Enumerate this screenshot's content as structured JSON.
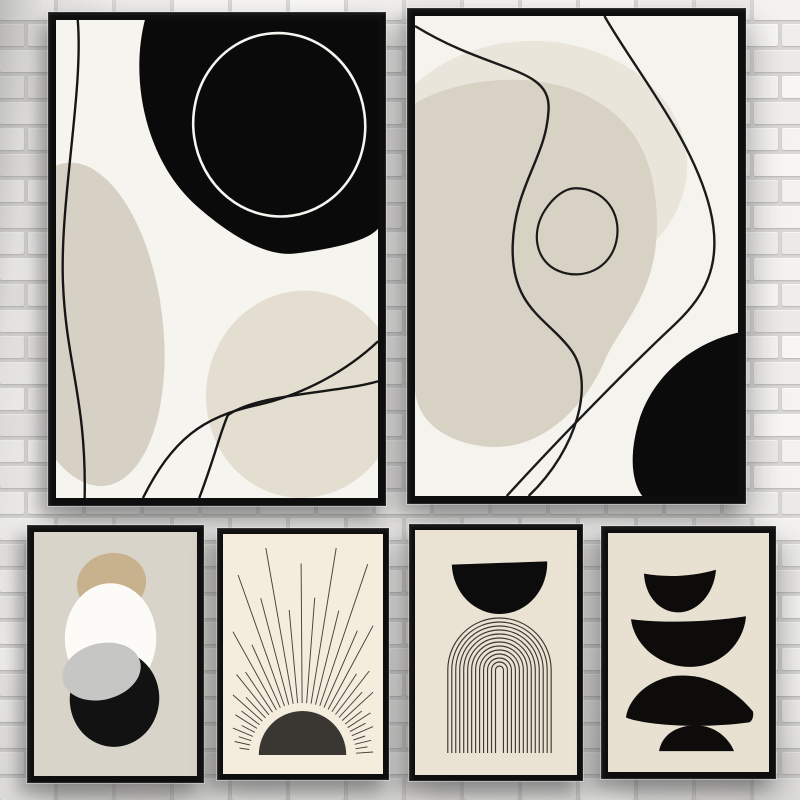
{
  "scene": {
    "description": "Photo of a gallery wall: six black-framed abstract boho art prints in black, off-white and beige hanging on a white painted brick wall",
    "wall": {
      "mortar_color": "#d9d8d6",
      "brick_colors": [
        "#f7f6f4",
        "#f3f2f0",
        "#efeeec",
        "#f4f3f1",
        "#eceae8"
      ]
    },
    "frame_color": "#0e0e0e"
  },
  "posters": [
    {
      "name": "abstract-black-blob-and-lines",
      "position": "top-left",
      "colors": {
        "bg": "#f6f4ef",
        "black": "#0a0a0a",
        "beige": "#d6d1c4",
        "beige_light": "#e3decf",
        "line": "#161616",
        "ring": "#f7f5f0"
      }
    },
    {
      "name": "abstract-beige-blob-and-lines",
      "position": "top-right",
      "colors": {
        "bg": "#f5f3ee",
        "black": "#0b0b0b",
        "beige": "#d8d2c5",
        "beige_light": "#eae5da",
        "line": "#1a1a1a"
      }
    },
    {
      "name": "stacked-organic-shapes",
      "position": "bottom-left",
      "colors": {
        "bg": "#d9d4c9",
        "tan": "#c8b28e",
        "white": "#fcfbf7",
        "gray": "#c6c6c4",
        "black": "#121212"
      }
    },
    {
      "name": "woodcut-sunrise",
      "position": "bottom-middle-left",
      "colors": {
        "bg": "#f4edde",
        "sun": "#3a3732",
        "rays": "#46413a"
      }
    },
    {
      "name": "black-dome-over-arches",
      "position": "bottom-middle-right",
      "colors": {
        "bg": "#eae3d4",
        "black": "#0c0c0c",
        "line": "#3b382f"
      }
    },
    {
      "name": "balanced-black-pebbles",
      "position": "bottom-right",
      "colors": {
        "bg": "#e8e1d1",
        "black": "#0d0c0a"
      }
    }
  ]
}
